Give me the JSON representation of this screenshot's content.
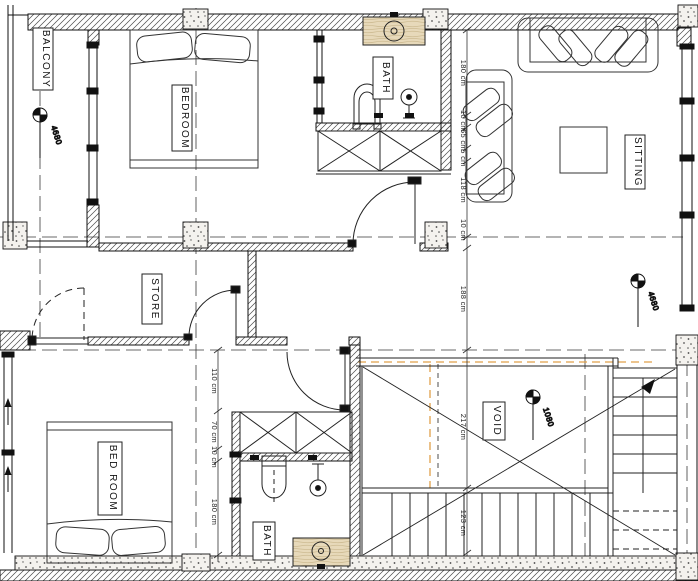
{
  "title": "First floor architectural plan",
  "colors": {
    "line": "#1a1a1a",
    "wood": "#e7d9ba",
    "accent_dash": "#e0a04a",
    "paper": "#ffffff"
  },
  "rooms": {
    "balcony": {
      "label": "BALCONY"
    },
    "bedroom_top": {
      "label": "BEDROOM"
    },
    "bath_top": {
      "label": "BATH"
    },
    "sitting": {
      "label": "SITTING"
    },
    "store": {
      "label": "STORE"
    },
    "bed_room": {
      "label": "BED ROOM"
    },
    "void": {
      "label": "VOID"
    },
    "bath_bottom": {
      "label": "BATH"
    }
  },
  "levels": {
    "balcony": "4680",
    "sitting": "4680",
    "void": "1080"
  },
  "dimensions": {
    "right_chain": [
      "180 cm",
      "10 cm",
      "65 cm",
      "5 cm",
      "118 cm",
      "10 cm",
      "188 cm",
      "217 cm",
      "123 cm"
    ],
    "hall_chain": [
      "110 cm",
      "70 cm",
      "10 cm",
      "180 cm"
    ]
  }
}
